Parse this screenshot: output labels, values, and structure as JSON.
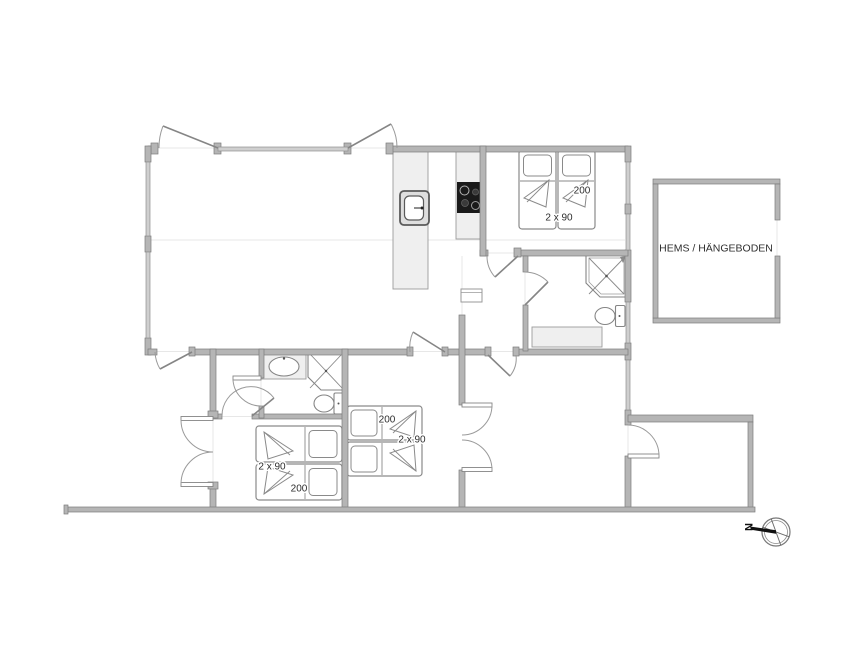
{
  "floorplan": {
    "loft_room": {
      "label": "HEMS / HÄNGEBODEN"
    },
    "bedroom_top_right": {
      "length_label": "200",
      "width_label": "2 x 90"
    },
    "bedroom_bottom_left": {
      "width_label": "2 x 90",
      "length_label": "200"
    },
    "bedroom_bottom_middle": {
      "length_label": "200",
      "width_label": "2 x 90"
    },
    "compass": {
      "north_label": "N"
    },
    "colors": {
      "wall": "#b5b5b5",
      "wall_edge": "#7c7c7c",
      "counter_fill": "#efefef",
      "cooktop": "#1a1a1a",
      "fixture_outline": "#858585",
      "label_text": "#2e2e2e",
      "background": "#ffffff"
    }
  }
}
